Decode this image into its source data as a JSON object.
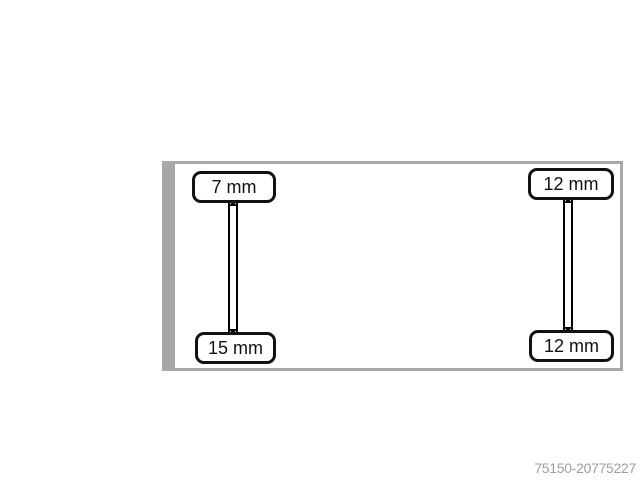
{
  "colors": {
    "background": "#ffffff",
    "board_border": "#a8a8a8",
    "board_fill": "#ffffff",
    "label_border": "#111111",
    "label_fill": "#ffffff",
    "label_text": "#111111",
    "connector": "#000000",
    "watermark_text": "#9e9e9e"
  },
  "diagram": {
    "labels": {
      "top_left": "7 mm",
      "top_right": "12 mm",
      "bottom_left": "15 mm",
      "bottom_right": "12 mm"
    }
  },
  "watermark": {
    "id_text": "75150-20775227"
  }
}
